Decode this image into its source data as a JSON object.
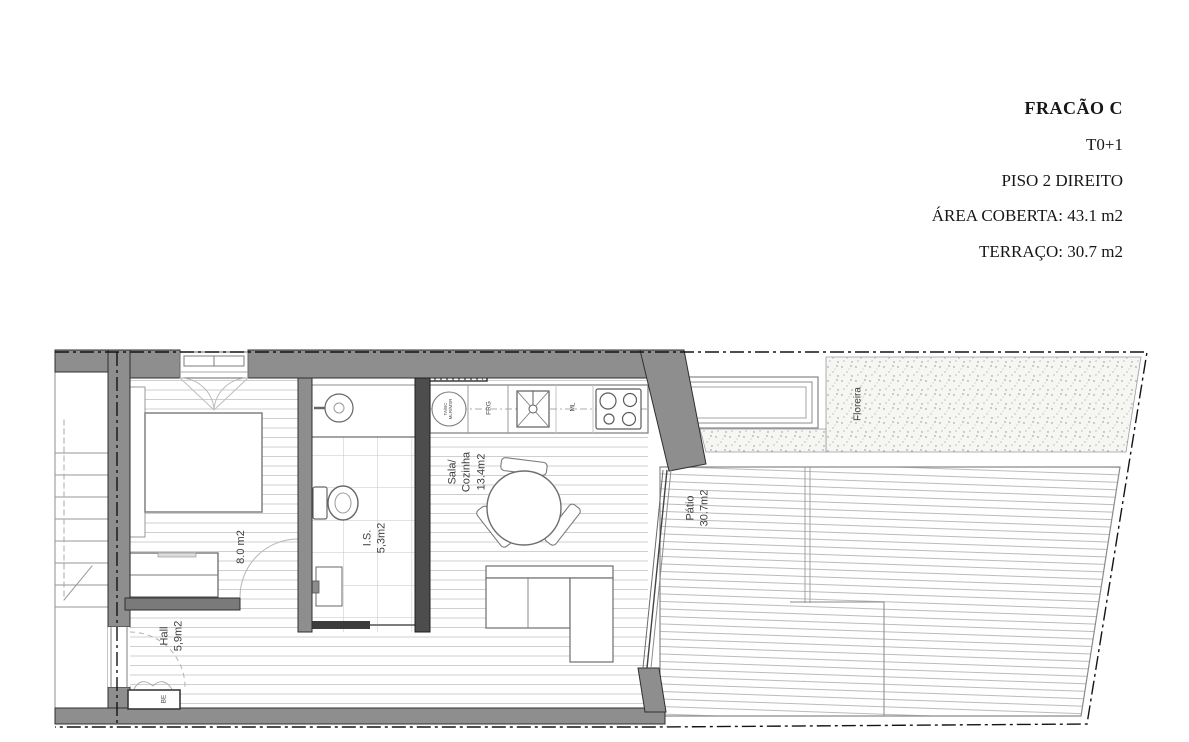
{
  "header": {
    "fraction_title": "FRACÃO C",
    "typology": "T0+1",
    "floor": "PISO 2 DIREITO",
    "covered_area": "ÁREA COBERTA: 43.1 m2",
    "terrace_area": "TERRAÇO: 30.7 m2"
  },
  "plan": {
    "bedroom": {
      "area": "8.0 m2"
    },
    "hall": {
      "name": "Hall",
      "area": "5,9m2"
    },
    "bathroom": {
      "name": "I.S.",
      "area": "5,3m2"
    },
    "living_kitchen": {
      "name_top": "Sala/",
      "name_bottom": "Cozinha",
      "area": "13.4m2"
    },
    "patio": {
      "name": "Pátio",
      "area": "30.7m2"
    },
    "planter": {
      "name": "Floreira"
    },
    "closet_label": "BE",
    "appliances": {
      "washer_line1": "TA/BC",
      "washer_line2": "MLR/MSR",
      "fridge": "FRG",
      "dishwasher": "ML"
    }
  }
}
